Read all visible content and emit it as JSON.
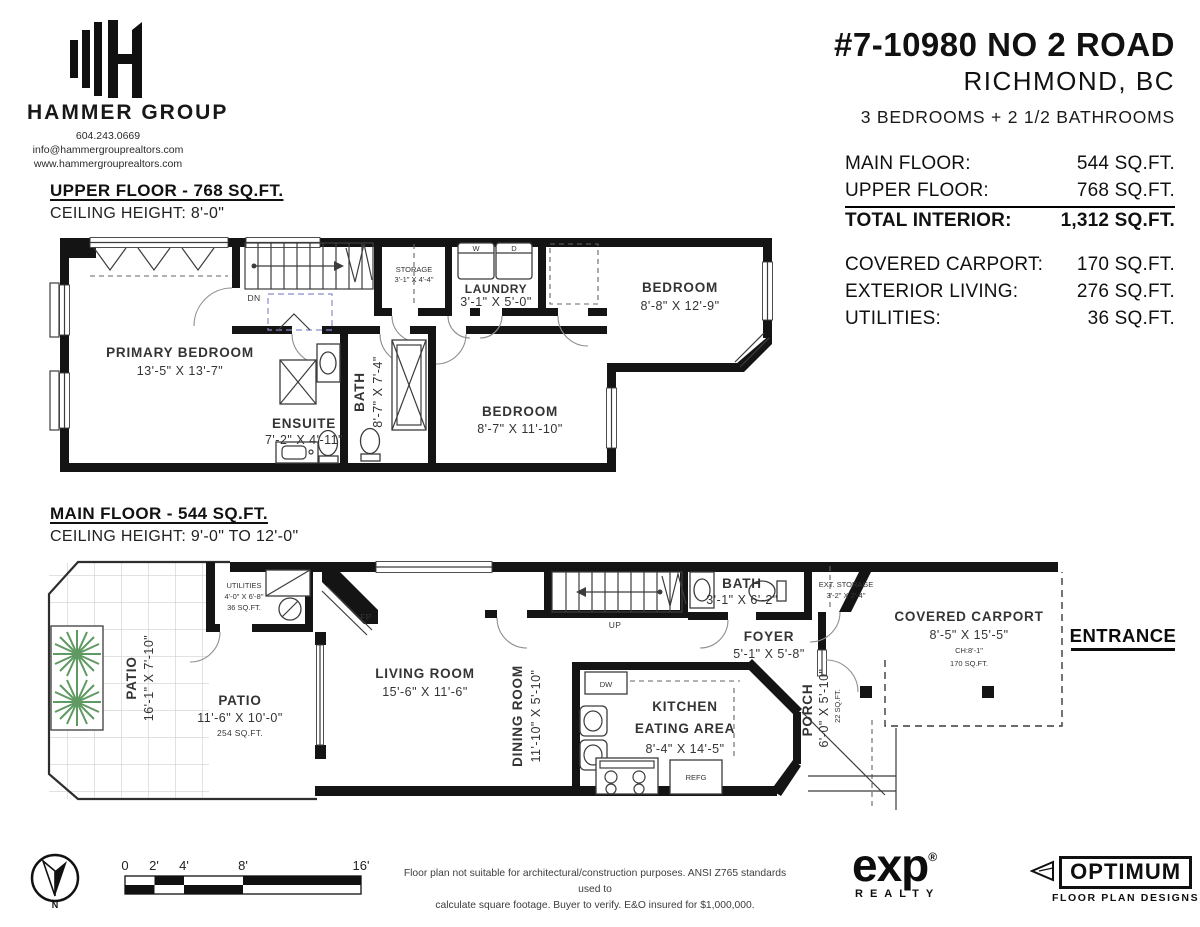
{
  "branding": {
    "name": "HAMMER GROUP",
    "phone": "604.243.0669",
    "email": "info@hammergrouprealtors.com",
    "website": "www.hammergrouprealtors.com"
  },
  "header": {
    "address": "#7-10980 NO 2 ROAD",
    "city": "RICHMOND, BC",
    "bedbath": "3 BEDROOMS + 2 1/2 BATHROOMS"
  },
  "areas": {
    "main": {
      "label": "MAIN FLOOR:",
      "value": "544 SQ.FT."
    },
    "upper": {
      "label": "UPPER FLOOR:",
      "value": "768 SQ.FT."
    },
    "total": {
      "label": "TOTAL INTERIOR:",
      "value": "1,312 SQ.FT."
    },
    "carport": {
      "label": "COVERED CARPORT:",
      "value": "170 SQ.FT."
    },
    "exterior": {
      "label": "EXTERIOR LIVING:",
      "value": "276 SQ.FT."
    },
    "utilities": {
      "label": "UTILITIES:",
      "value": "36 SQ.FT."
    }
  },
  "upper_floor": {
    "title": "UPPER FLOOR - 768 SQ.FT.",
    "ceiling": "CEILING HEIGHT: 8'-0\"",
    "primary": {
      "name": "PRIMARY BEDROOM",
      "dims": "13'-5\" X 13'-7\""
    },
    "ensuite": {
      "name": "ENSUITE",
      "dims": "7'-2\" X 4'-11\""
    },
    "bath": {
      "name": "BATH",
      "dims": "8'-7\" X 7'-4\""
    },
    "storage": {
      "name": "STORAGE",
      "dims": "3'-1\" X 4'-4\""
    },
    "laundry": {
      "name": "LAUNDRY",
      "dims": "3'-1\" X 5'-0\""
    },
    "bedroom_right": {
      "name": "BEDROOM",
      "dims": "8'-8\" X 12'-9\""
    },
    "bedroom_mid": {
      "name": "BEDROOM",
      "dims": "8'-7\" X 11'-10\""
    },
    "washer": "W",
    "dryer": "D",
    "down": "DN"
  },
  "main_floor": {
    "title": "MAIN FLOOR - 544 SQ.FT.",
    "ceiling": "CEILING HEIGHT: 9'-0\" TO 12'-0\"",
    "patio_side": {
      "name": "PATIO",
      "dims": "16'-1\" X 7'-10\""
    },
    "patio": {
      "name": "PATIO",
      "dims": "11'-6\" X 10'-0\"",
      "area": "254 SQ.FT."
    },
    "utilities": {
      "name": "UTILITIES",
      "dims": "4'-0\" X 6'-8\"",
      "area": "36 SQ.FT."
    },
    "living": {
      "name": "LIVING ROOM",
      "dims": "15'-6\" X 11'-6\""
    },
    "dining": {
      "name": "DINING ROOM",
      "dims": "11'-10\" X 5'-10\""
    },
    "kitchen": {
      "name1": "KITCHEN",
      "name2": "EATING AREA",
      "dims": "8'-4\" X 14'-5\""
    },
    "bath": {
      "name": "BATH",
      "dims": "3'-1\" X 6'-2\""
    },
    "ext_storage": {
      "name": "EXT. STORAGE",
      "dims": "3'-2\" X 2'-4\""
    },
    "foyer": {
      "name": "FOYER",
      "dims": "5'-1\" X 5'-8\""
    },
    "porch": {
      "name": "PORCH",
      "dims": "6'-0\" X 5'-10\"",
      "area": "22 SQ.FT."
    },
    "carport": {
      "name": "COVERED CARPORT",
      "dims": "8'-5\" X 15'-5\"",
      "ch": "CH:8'-1\"",
      "area": "170 SQ.FT."
    },
    "up": "UP",
    "fp": "FP",
    "dw": "DW",
    "refg": "REFG",
    "entrance": "ENTRANCE"
  },
  "footer": {
    "north": "N",
    "scale_ticks": [
      "0",
      "2'",
      "4'",
      "8'",
      "16'"
    ],
    "disclaimer1": "Floor plan not suitable for architectural/construction purposes. ANSI Z765 standards used to",
    "disclaimer2": "calculate square footage. Buyer to verify.  E&O insured for $1,000,000.",
    "exp": {
      "name": "exp",
      "reg": "®",
      "sub": "REALTY"
    },
    "optimum": {
      "name": "OPTIMUM",
      "sub": "FLOOR PLAN DESIGNS"
    }
  },
  "colors": {
    "wall": "#141414",
    "plant": "#5e9a61",
    "closet_dash": "#8b8bd0"
  }
}
